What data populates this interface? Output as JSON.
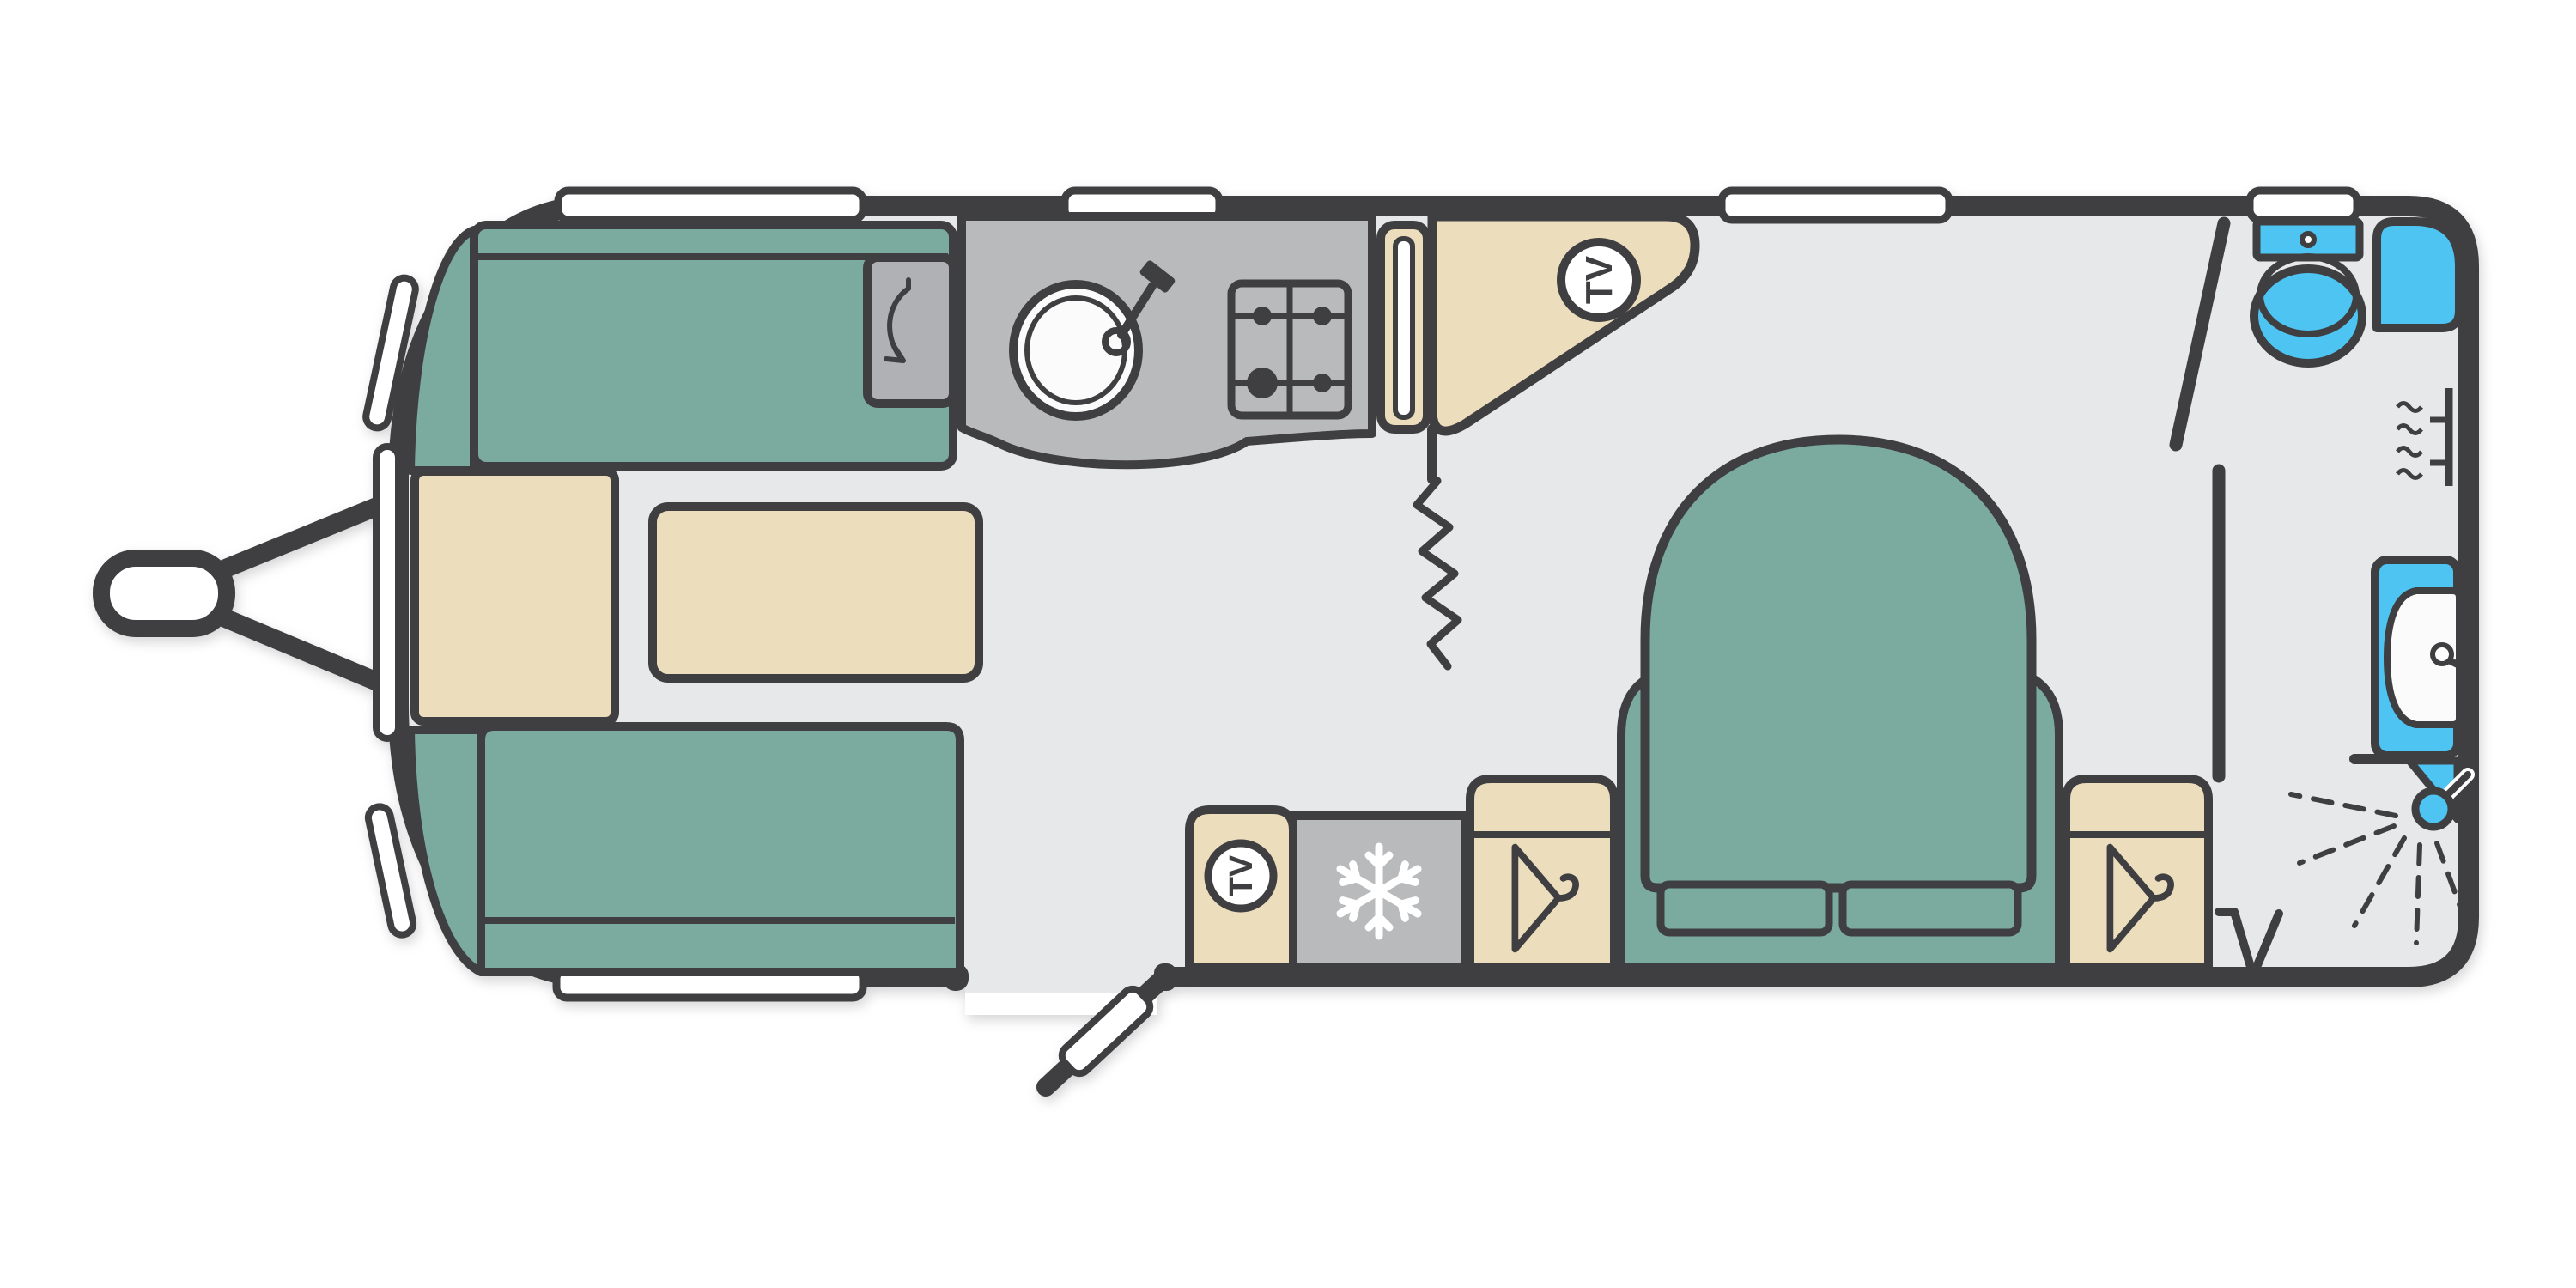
{
  "page": {
    "background": "#ffffff",
    "description_labels": {
      "tv_lounge": "TV",
      "tv_bedroom": "TV"
    }
  },
  "colors": {
    "page": "#ffffff",
    "outline": "#3f3f41",
    "floor": "#e7e8ea",
    "teal": "#7bab9f",
    "cream": "#ecddbd",
    "grey": "#b9babc",
    "grey_dark": "#b0b1b4",
    "blue": "#4dc4f1",
    "white": "#ffffff",
    "basin_white": "#fbfbfb",
    "shadow": "rgba(70,70,75,0.22)"
  },
  "icons": {
    "tv_points": "tv-point-circle",
    "fridge": "snowflake-icon",
    "wardrobes": "hanger-icon",
    "kitchen": [
      "sink-with-tap-icon",
      "gas-hob-4-burner-icon"
    ],
    "lounge": "flip-shelf-arrow-icon",
    "washroom": [
      "toilet-icon",
      "shower-tray-icon",
      "towel-rail-icon",
      "washbasin-icon",
      "shower-head-spray-icon"
    ],
    "doors": [
      "entrance-door-open",
      "washroom-door-ajar",
      "door-swing-mark",
      "curtain-zigzag-divider"
    ],
    "chassis": "tow-hitch-a-frame"
  }
}
